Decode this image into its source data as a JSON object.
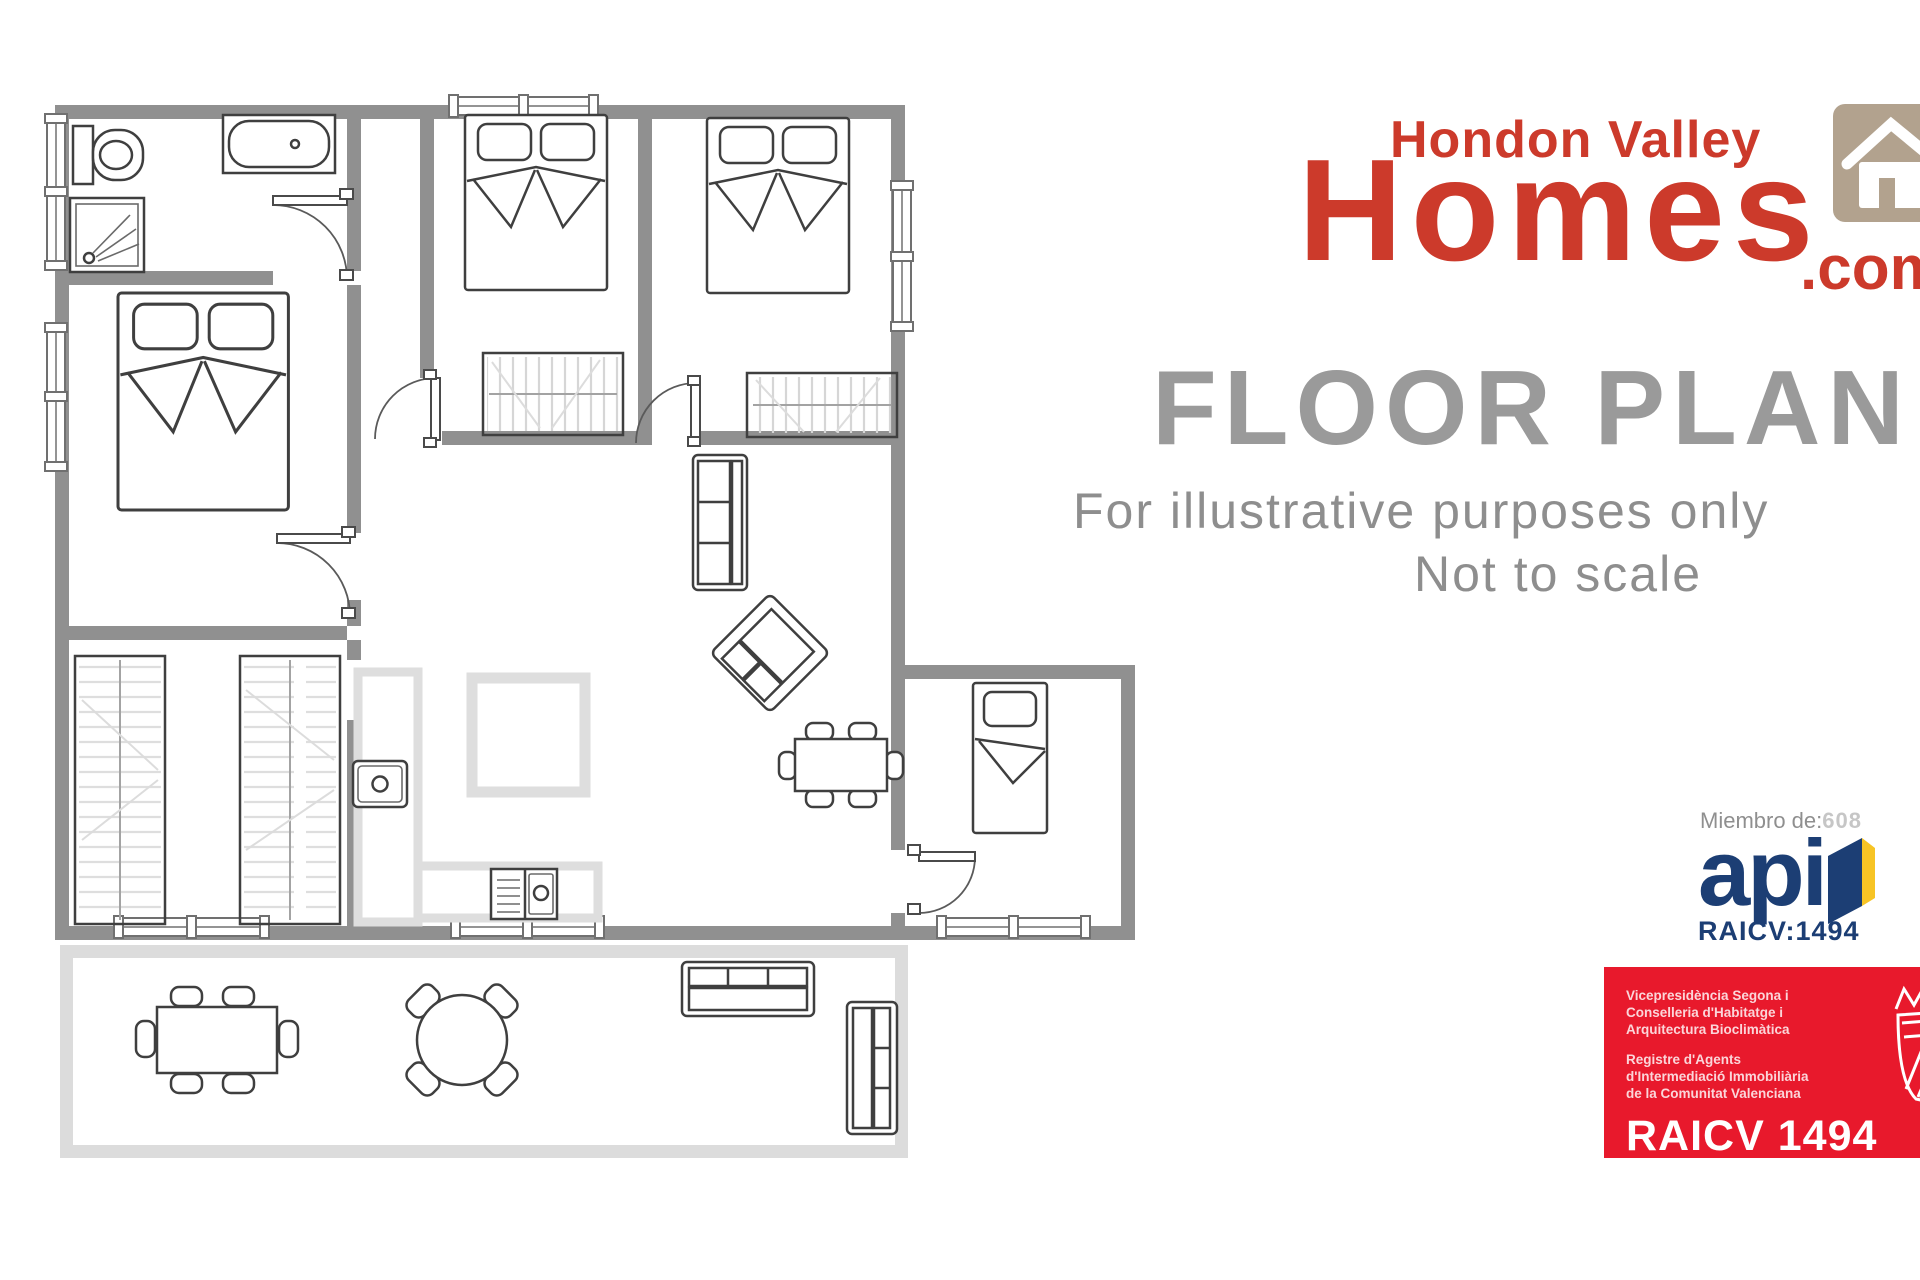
{
  "branding": {
    "logo_line1": "Hondon Valley",
    "logo_line2": "Homes",
    "logo_suffix": ".com",
    "logo_color": "#cc3a2b",
    "house_icon_bg": "#b2a28e",
    "title": "FLOOR PLAN",
    "title_color": "#9a9a9a",
    "tagline_line1": "For illustrative purposes only",
    "tagline_line2": "Not to scale"
  },
  "membership": {
    "miembro_label": "Miembro de:",
    "miembro_number": "608",
    "api_logo_text": "api",
    "raicv_line": "RAICV:1494",
    "navy_color": "#1c3e74",
    "door_yellow_color": "#f7c425"
  },
  "badge": {
    "bg_color": "#e8192c",
    "block1": [
      "Vicepresidència Segona i",
      "Conselleria d'Habitatge i",
      "Arquitectura Bioclimàtica"
    ],
    "block2": [
      "Registre d'Agents",
      "d'Intermediació Immobiliària",
      "de la Comunitat Valenciana"
    ],
    "number": "RAICV 1494"
  },
  "floorplan": {
    "wall_color": "#909090",
    "terrace_wall_color": "#dcdcdc",
    "counter_color": "#dedede",
    "furniture_stroke": "#3f3f3f"
  }
}
